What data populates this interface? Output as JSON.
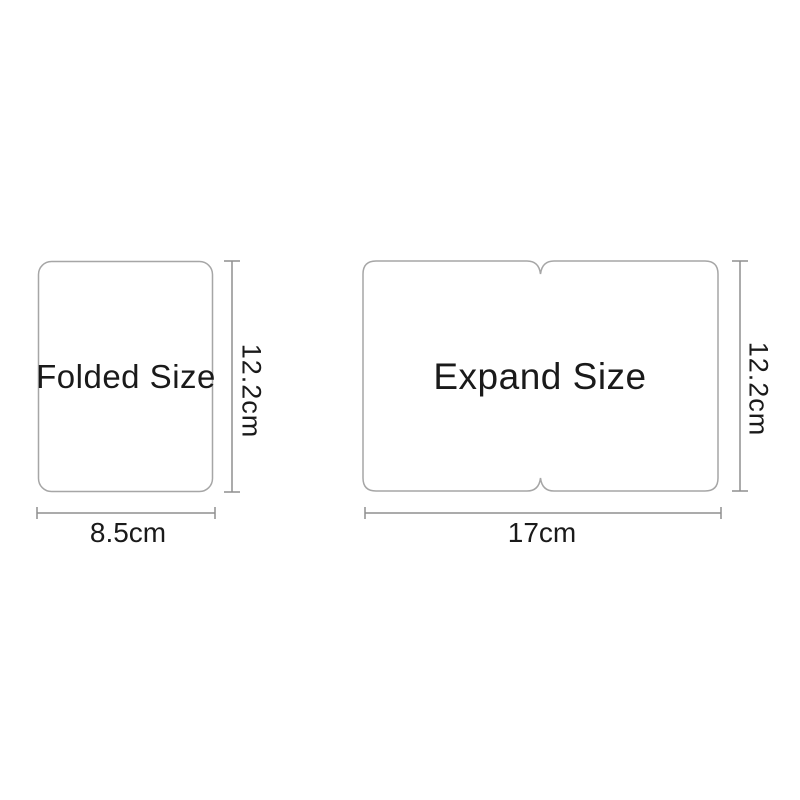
{
  "diagram": {
    "folded": {
      "label": "Folded Size",
      "width_label": "8.5cm",
      "height_label": "12.2cm"
    },
    "expand": {
      "label": "Expand Size",
      "width_label": "17cm",
      "height_label": "12.2cm"
    }
  },
  "colors": {
    "background": "#ffffff",
    "outline": "#a6a6a6",
    "dimension_line": "#8f8f8f",
    "text": "#1a1a1a"
  }
}
